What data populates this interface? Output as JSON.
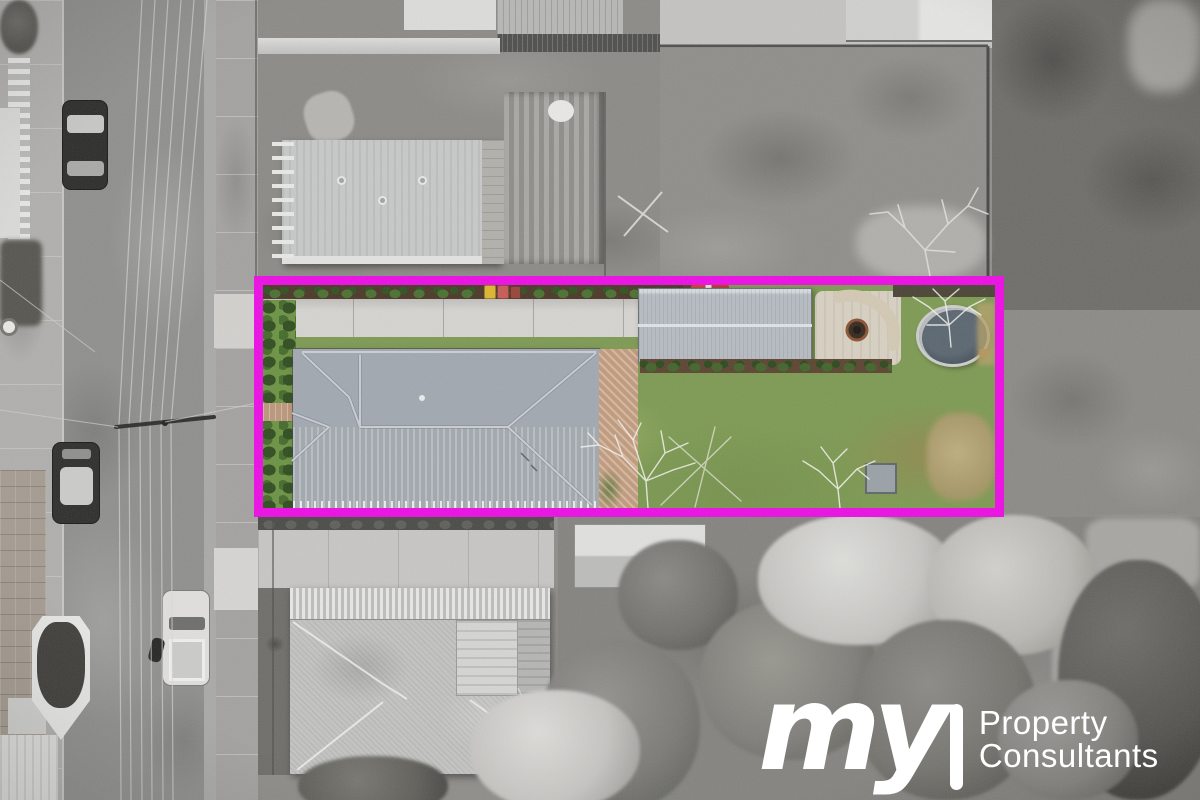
{
  "image": {
    "kind": "aerial-drone-photo",
    "treatment": "grayscale background with full-colour highlighted lot",
    "highlight_shape": "rectangle"
  },
  "branding": {
    "logo_script": "my",
    "logo_word1": "Property",
    "logo_word2": "Consultants"
  },
  "palette": {
    "magenta": "#ec0de4",
    "logo_color": "#ffffff",
    "street": "#8f8f8d",
    "concrete": "#d5d4d0",
    "lawn": "#7d9a52",
    "roof_main": "#a2a8b0",
    "roof_shed": "#b6bcc2",
    "brick": "#c19a7b",
    "hedge": "#35541f",
    "pool_water": "#4d5963",
    "stone_court": "#d8d1c2"
  }
}
